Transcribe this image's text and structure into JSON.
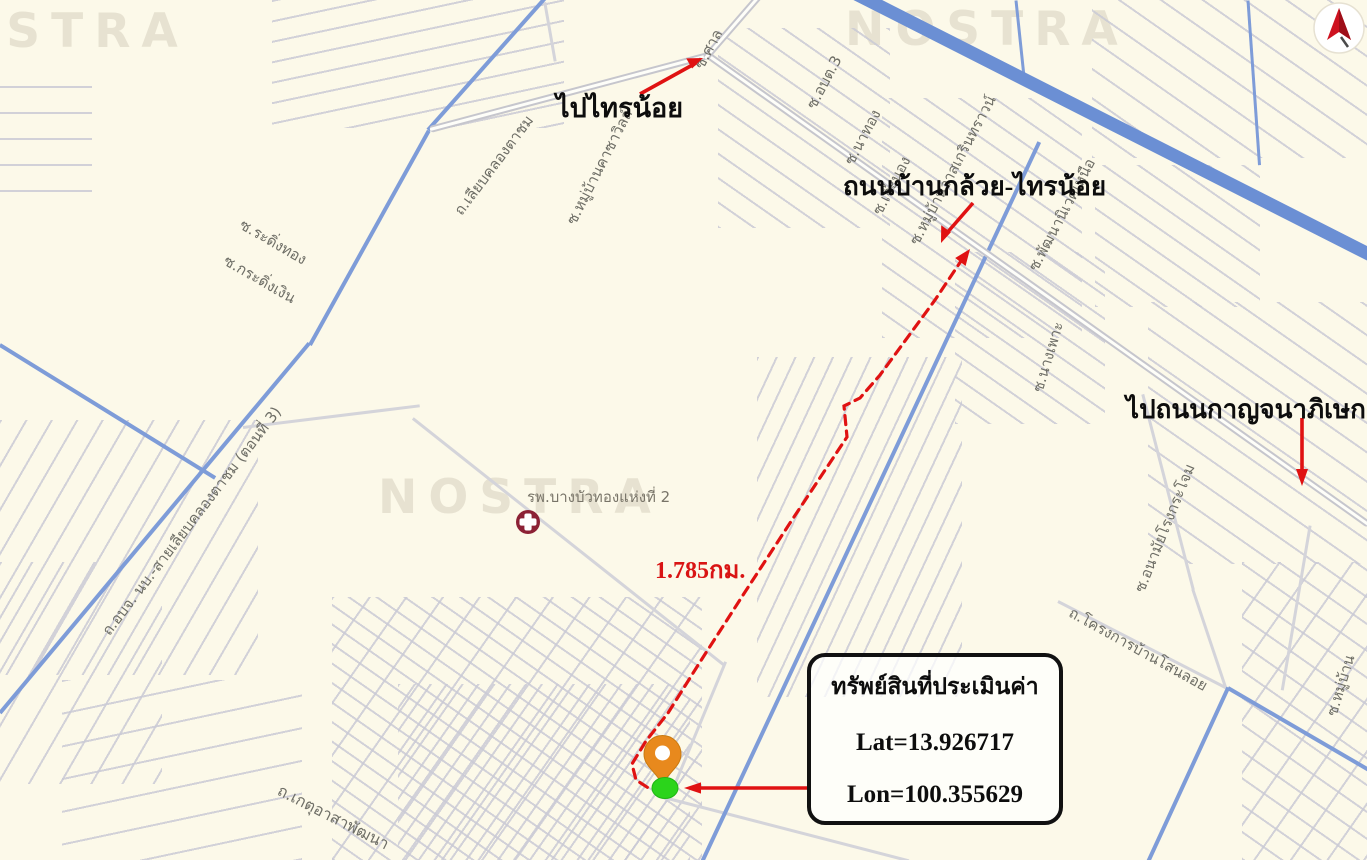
{
  "map": {
    "watermark": "NOSTRA",
    "background_color": "#FCF9E9",
    "colors": {
      "road_blue": "#7E9CD8",
      "canal_blue": "#6B8FD4",
      "road_gray": "#D6D6DB",
      "annotation_red": "#E01212",
      "pin_orange": "#E8891D",
      "dot_green": "#2BD41B",
      "hospital_maroon": "#8C2135"
    },
    "annotations": {
      "to_sai_noi": "ไปไทรน้อย",
      "road_name": "ถนนบ้านกล้วย-ไทรน้อย",
      "to_kanchanaphisek": "ไปถนนกาญจนาภิเษก",
      "distance": "1.785กม."
    },
    "callout": {
      "title": "ทรัพย์สินที่ประเมินค่า",
      "lat": "Lat=13.926717",
      "lon": "Lon=100.355629"
    },
    "poi": {
      "hospital": "รพ.บางบัวทองแห่งที่ 2"
    },
    "street_labels": [
      "ถ.เลียบคลองตาชม",
      "ซ.หมู่บ้านคาซาวิลล์",
      "ซ.ศาล",
      "ซ.อบต.3",
      "ซ.นาทอง",
      "ซ.เจ๊ะนอง",
      "ซ.หมู่บ้านวาสเกรินทราวน์",
      "ซ.พัฒนานิเวศเหนือ",
      "ซ.นางเพาะ",
      "ซ.ระดิ่งทอง",
      "ซ.กระดิ่งเงิน",
      "ถ.อบจ. นบ.-สายเลียบคลองตาชม (ตอนที่ 3)",
      "ซ.อนามัยโรงกระโจม",
      "ถ.โครงการบ้านโสนลอย",
      "ถ.เกตุอาสาพัฒนา",
      "ซ.หมู่บ้าน"
    ],
    "compass": {
      "icon": "north-arrow"
    }
  }
}
